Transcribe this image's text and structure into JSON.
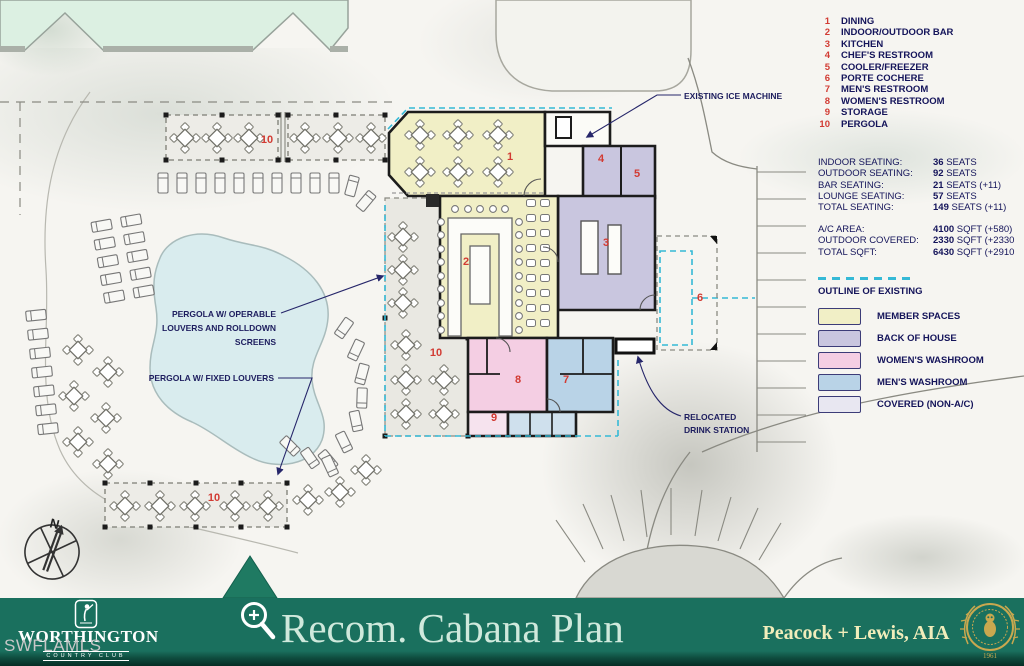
{
  "site": {
    "watermark": "SWFLAMLS",
    "compass_label": "N"
  },
  "room_list": {
    "items": [
      {
        "num": "1",
        "label": "DINING"
      },
      {
        "num": "2",
        "label": "INDOOR/OUTDOOR BAR"
      },
      {
        "num": "3",
        "label": "KITCHEN"
      },
      {
        "num": "4",
        "label": "CHEF'S RESTROOM"
      },
      {
        "num": "5",
        "label": "COOLER/FREEZER"
      },
      {
        "num": "6",
        "label": "PORTE COCHERE"
      },
      {
        "num": "7",
        "label": "MEN'S RESTROOM"
      },
      {
        "num": "8",
        "label": "WOMEN'S RESTROOM"
      },
      {
        "num": "9",
        "label": "STORAGE"
      },
      {
        "num": "10",
        "label": "PERGOLA"
      }
    ]
  },
  "stats": {
    "seating": [
      {
        "label": "INDOOR SEATING:",
        "value": "36",
        "suffix": " SEATS"
      },
      {
        "label": "OUTDOOR SEATING:",
        "value": "92",
        "suffix": " SEATS"
      },
      {
        "label": "BAR SEATING:",
        "value": "21",
        "suffix": " SEATS (+11)"
      },
      {
        "label": "LOUNGE SEATING:",
        "value": "57",
        "suffix": " SEATS"
      },
      {
        "label": "TOTAL SEATING:",
        "value": "149",
        "suffix": " SEATS (+11)"
      }
    ],
    "areas": [
      {
        "label": "A/C AREA:",
        "value": "4100",
        "suffix": " SQFT (+580)"
      },
      {
        "label": "OUTDOOR COVERED:",
        "value": "2330",
        "suffix": " SQFT (+2330"
      },
      {
        "label": "TOTAL SQFT:",
        "value": "6430",
        "suffix": " SQFT (+2910"
      }
    ]
  },
  "legend": {
    "outline_label": "OUTLINE OF EXISTING",
    "items": [
      {
        "label": "MEMBER SPACES",
        "color": "#f1efc6"
      },
      {
        "label": "BACK OF HOUSE",
        "color": "#c9c6df"
      },
      {
        "label": "WOMEN'S WASHROOM",
        "color": "#f4cee3"
      },
      {
        "label": "MEN'S WASHROOM",
        "color": "#b9d3e7"
      },
      {
        "label": "COVERED (NON-A/C)",
        "color": "#e8e7f1"
      }
    ]
  },
  "annotations": {
    "ice_machine": "EXISTING ICE MACHINE",
    "pergola_operable_line1": "PERGOLA W/ OPERABLE",
    "pergola_operable_line2": "LOUVERS AND ROLLDOWN",
    "pergola_operable_line3": "SCREENS",
    "pergola_fixed": "PERGOLA W/ FIXED LOUVERS",
    "drink_line1": "RELOCATED",
    "drink_line2": "DRINK STATION"
  },
  "plan": {
    "numbers": {
      "n1": "1",
      "n2": "2",
      "n3": "3",
      "n4": "4",
      "n5": "5",
      "n6": "6",
      "n7": "7",
      "n8": "8",
      "n9": "9",
      "n10": "10"
    }
  },
  "footer": {
    "logo_name": "WORTHINGTON",
    "logo_sub": "COUNTRY CLUB",
    "title": "Recom. Cabana Plan",
    "architect": "Peacock + Lewis, AIA",
    "seal_year": "1961"
  },
  "colors": {
    "banner_teal": "#1a705e",
    "accent_red": "#d23b33",
    "ink_navy": "#14145a",
    "outline_cyan": "#35b9d6",
    "member_yellow": "#f1efc6",
    "back_of_house": "#c9c6df",
    "womens_pink": "#f4cee3",
    "mens_blue": "#b9d3e7",
    "covered_gray": "#e8e7f1"
  }
}
